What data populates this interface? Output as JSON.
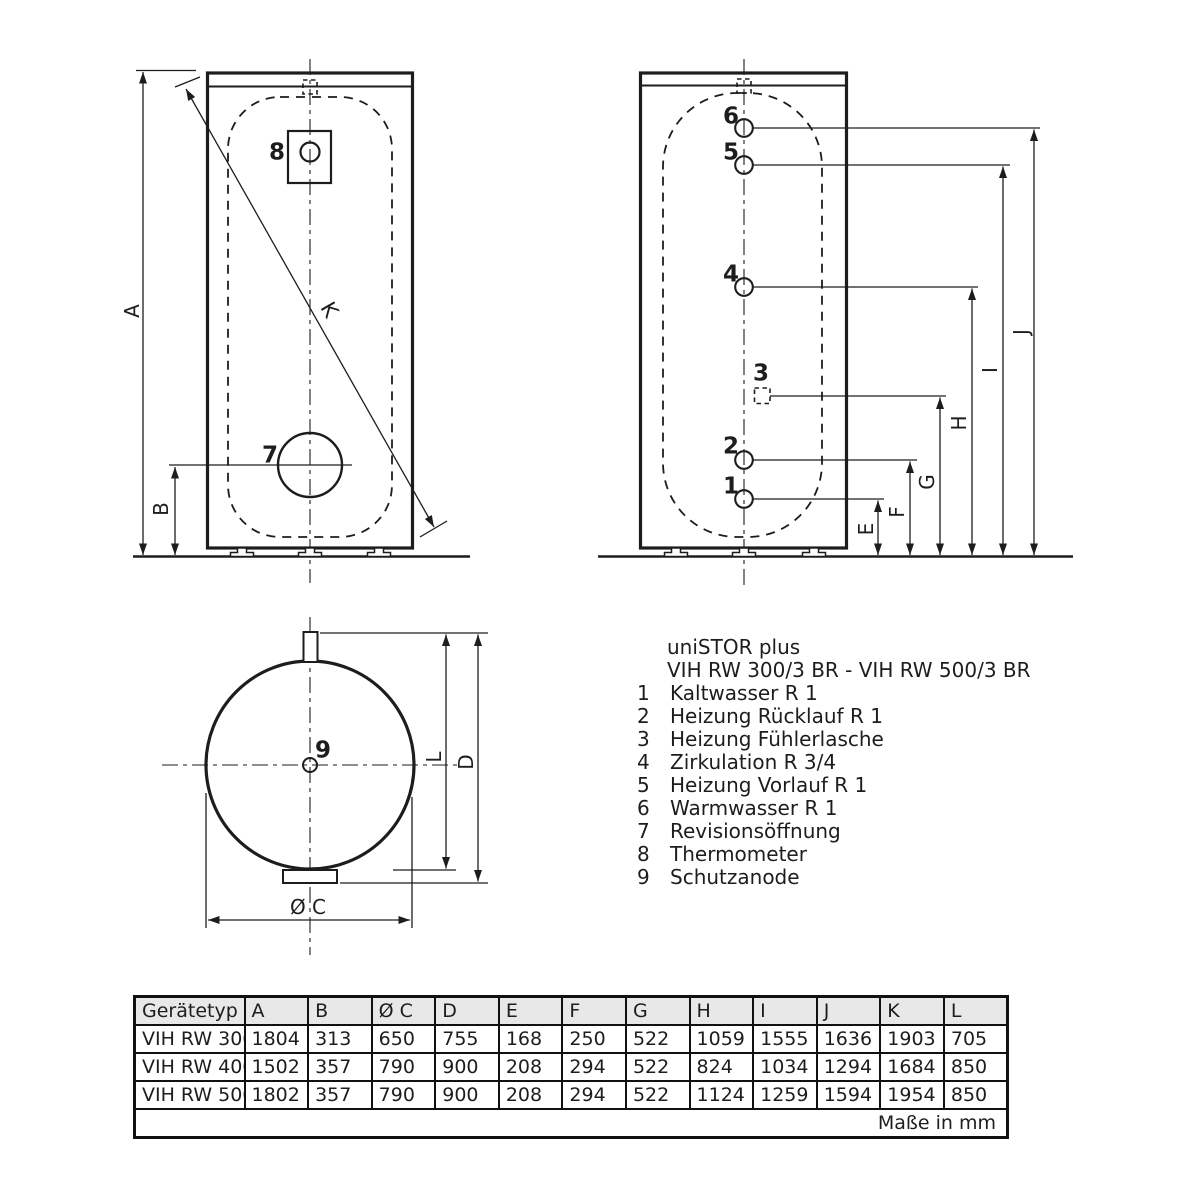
{
  "page": {
    "background": "#ffffff",
    "ink": "#1d1d1b",
    "table_header_bg": "#e8e8e8"
  },
  "product": {
    "title": "uniSTOR plus",
    "subtitle": "VIH RW 300/3 BR - VIH RW 500/3 BR"
  },
  "legend": {
    "items": [
      {
        "num": "1",
        "label": "Kaltwasser R 1"
      },
      {
        "num": "2",
        "label": "Heizung Rücklauf R 1"
      },
      {
        "num": "3",
        "label": "Heizung Fühlerlasche"
      },
      {
        "num": "4",
        "label": "Zirkulation R 3/4"
      },
      {
        "num": "5",
        "label": "Heizung Vorlauf R 1"
      },
      {
        "num": "6",
        "label": "Warmwasser R 1"
      },
      {
        "num": "7",
        "label": "Revisionsöffnung"
      },
      {
        "num": "8",
        "label": "Thermometer"
      },
      {
        "num": "9",
        "label": "Schutzanode"
      }
    ]
  },
  "front_view": {
    "dims": {
      "a": "A",
      "b": "B",
      "k": "K"
    },
    "callouts": {
      "thermometer": "8",
      "revision": "7"
    }
  },
  "side_view": {
    "callouts": {
      "c1": "1",
      "c2": "2",
      "c3": "3",
      "c4": "4",
      "c5": "5",
      "c6": "6"
    },
    "dims": {
      "e": "E",
      "f": "F",
      "g": "G",
      "h": "H",
      "i": "I",
      "j": "J"
    }
  },
  "top_view": {
    "callouts": {
      "anode": "9"
    },
    "dims": {
      "l": "L",
      "d": "D",
      "c": "Ø C"
    }
  },
  "table": {
    "headers": [
      "Gerätetyp",
      "A",
      "B",
      "Ø C",
      "D",
      "E",
      "F",
      "G",
      "H",
      "I",
      "J",
      "K",
      "L"
    ],
    "rows": [
      [
        "VIH RW 300",
        "1804",
        "313",
        "650",
        "755",
        "168",
        "250",
        "522",
        "1059",
        "1555",
        "1636",
        "1903",
        "705"
      ],
      [
        "VIH RW 400",
        "1502",
        "357",
        "790",
        "900",
        "208",
        "294",
        "522",
        "824",
        "1034",
        "1294",
        "1684",
        "850"
      ],
      [
        "VIH RW 500",
        "1802",
        "357",
        "790",
        "900",
        "208",
        "294",
        "522",
        "1124",
        "1259",
        "1594",
        "1954",
        "850"
      ]
    ],
    "footer": "Maße in mm"
  }
}
